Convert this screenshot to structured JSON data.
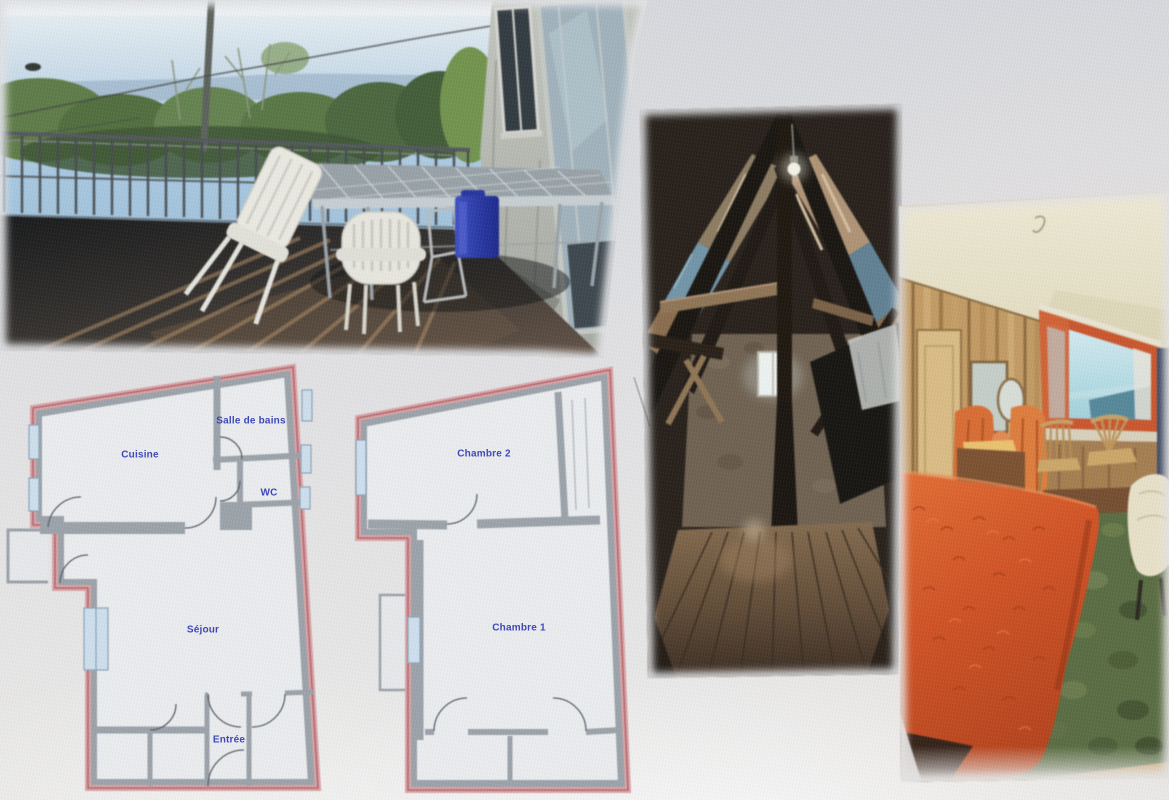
{
  "collage": {
    "photos": [
      {
        "id": "terrace-photo",
        "alt": "balcony terrace with metal railing, garden table, white plastic chairs, blue jerrycan, old grey wall with window and glazed door, trees and hills beyond"
      },
      {
        "id": "attic-photo",
        "alt": "dark attic under A-frame timber roof with hanging bulb, stone gable wall, small bright window and wide wooden floorboards"
      },
      {
        "id": "bedroom-photo",
        "alt": "wood-panelled bedroom with orange bedspread, green carpet, vanity mirror, two wooden chairs and orange-framed window with a view"
      }
    ],
    "floorplans": [
      {
        "id": "ground-floor-plan",
        "rooms": [
          {
            "id": "cuisine",
            "label": "Cuisine"
          },
          {
            "id": "salle-de-bains",
            "label": "Salle de bains"
          },
          {
            "id": "wc",
            "label": "WC"
          },
          {
            "id": "sejour",
            "label": "Séjour"
          },
          {
            "id": "entree",
            "label": "Entrée"
          }
        ]
      },
      {
        "id": "first-floor-plan",
        "rooms": [
          {
            "id": "chambre-2",
            "label": "Chambre 2"
          },
          {
            "id": "chambre-1",
            "label": "Chambre 1"
          }
        ]
      }
    ],
    "colors": {
      "background": "#e2e2e4",
      "plan_outline_pink": "#dca3a6",
      "plan_wall_gray": "#9ba2a9",
      "plan_room_fill": "#eceef0",
      "room_label_blue": "#2a33b5",
      "bedspread_orange": "#d94f1e",
      "jerrycan_blue": "#2436a8"
    }
  }
}
